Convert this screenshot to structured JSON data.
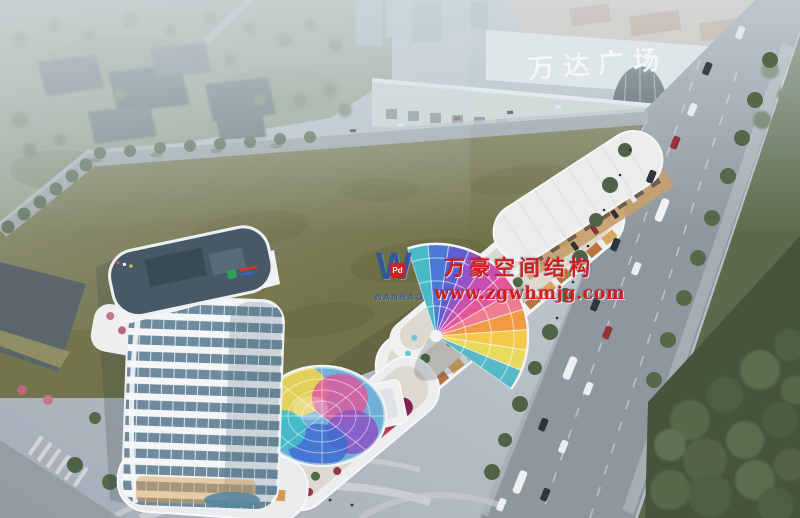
{
  "signs": {
    "mall": "万达广场"
  },
  "watermark": {
    "logo_letter": "W",
    "logo_badge": "Pd",
    "logo_subtext": "WANHAO",
    "company": "万豪空间结构",
    "website": "www.zgwhmjg.com",
    "text_color": "#d01d1d",
    "logo_color": "#2a55a5"
  },
  "scene": {
    "type": "aerial architectural rendering of a mixed-use commercial plaza",
    "palette": {
      "haze": "#c8d4da",
      "lawn": "#73744b",
      "road": "#8e979e",
      "building_white": "#eceeef",
      "tower_glass": "#6e8a9c",
      "canopy_rainbow": [
        "#49b9c8",
        "#4a79d6",
        "#9553c8",
        "#c94fae",
        "#e2569a",
        "#f09a44",
        "#f4c94c"
      ]
    }
  }
}
